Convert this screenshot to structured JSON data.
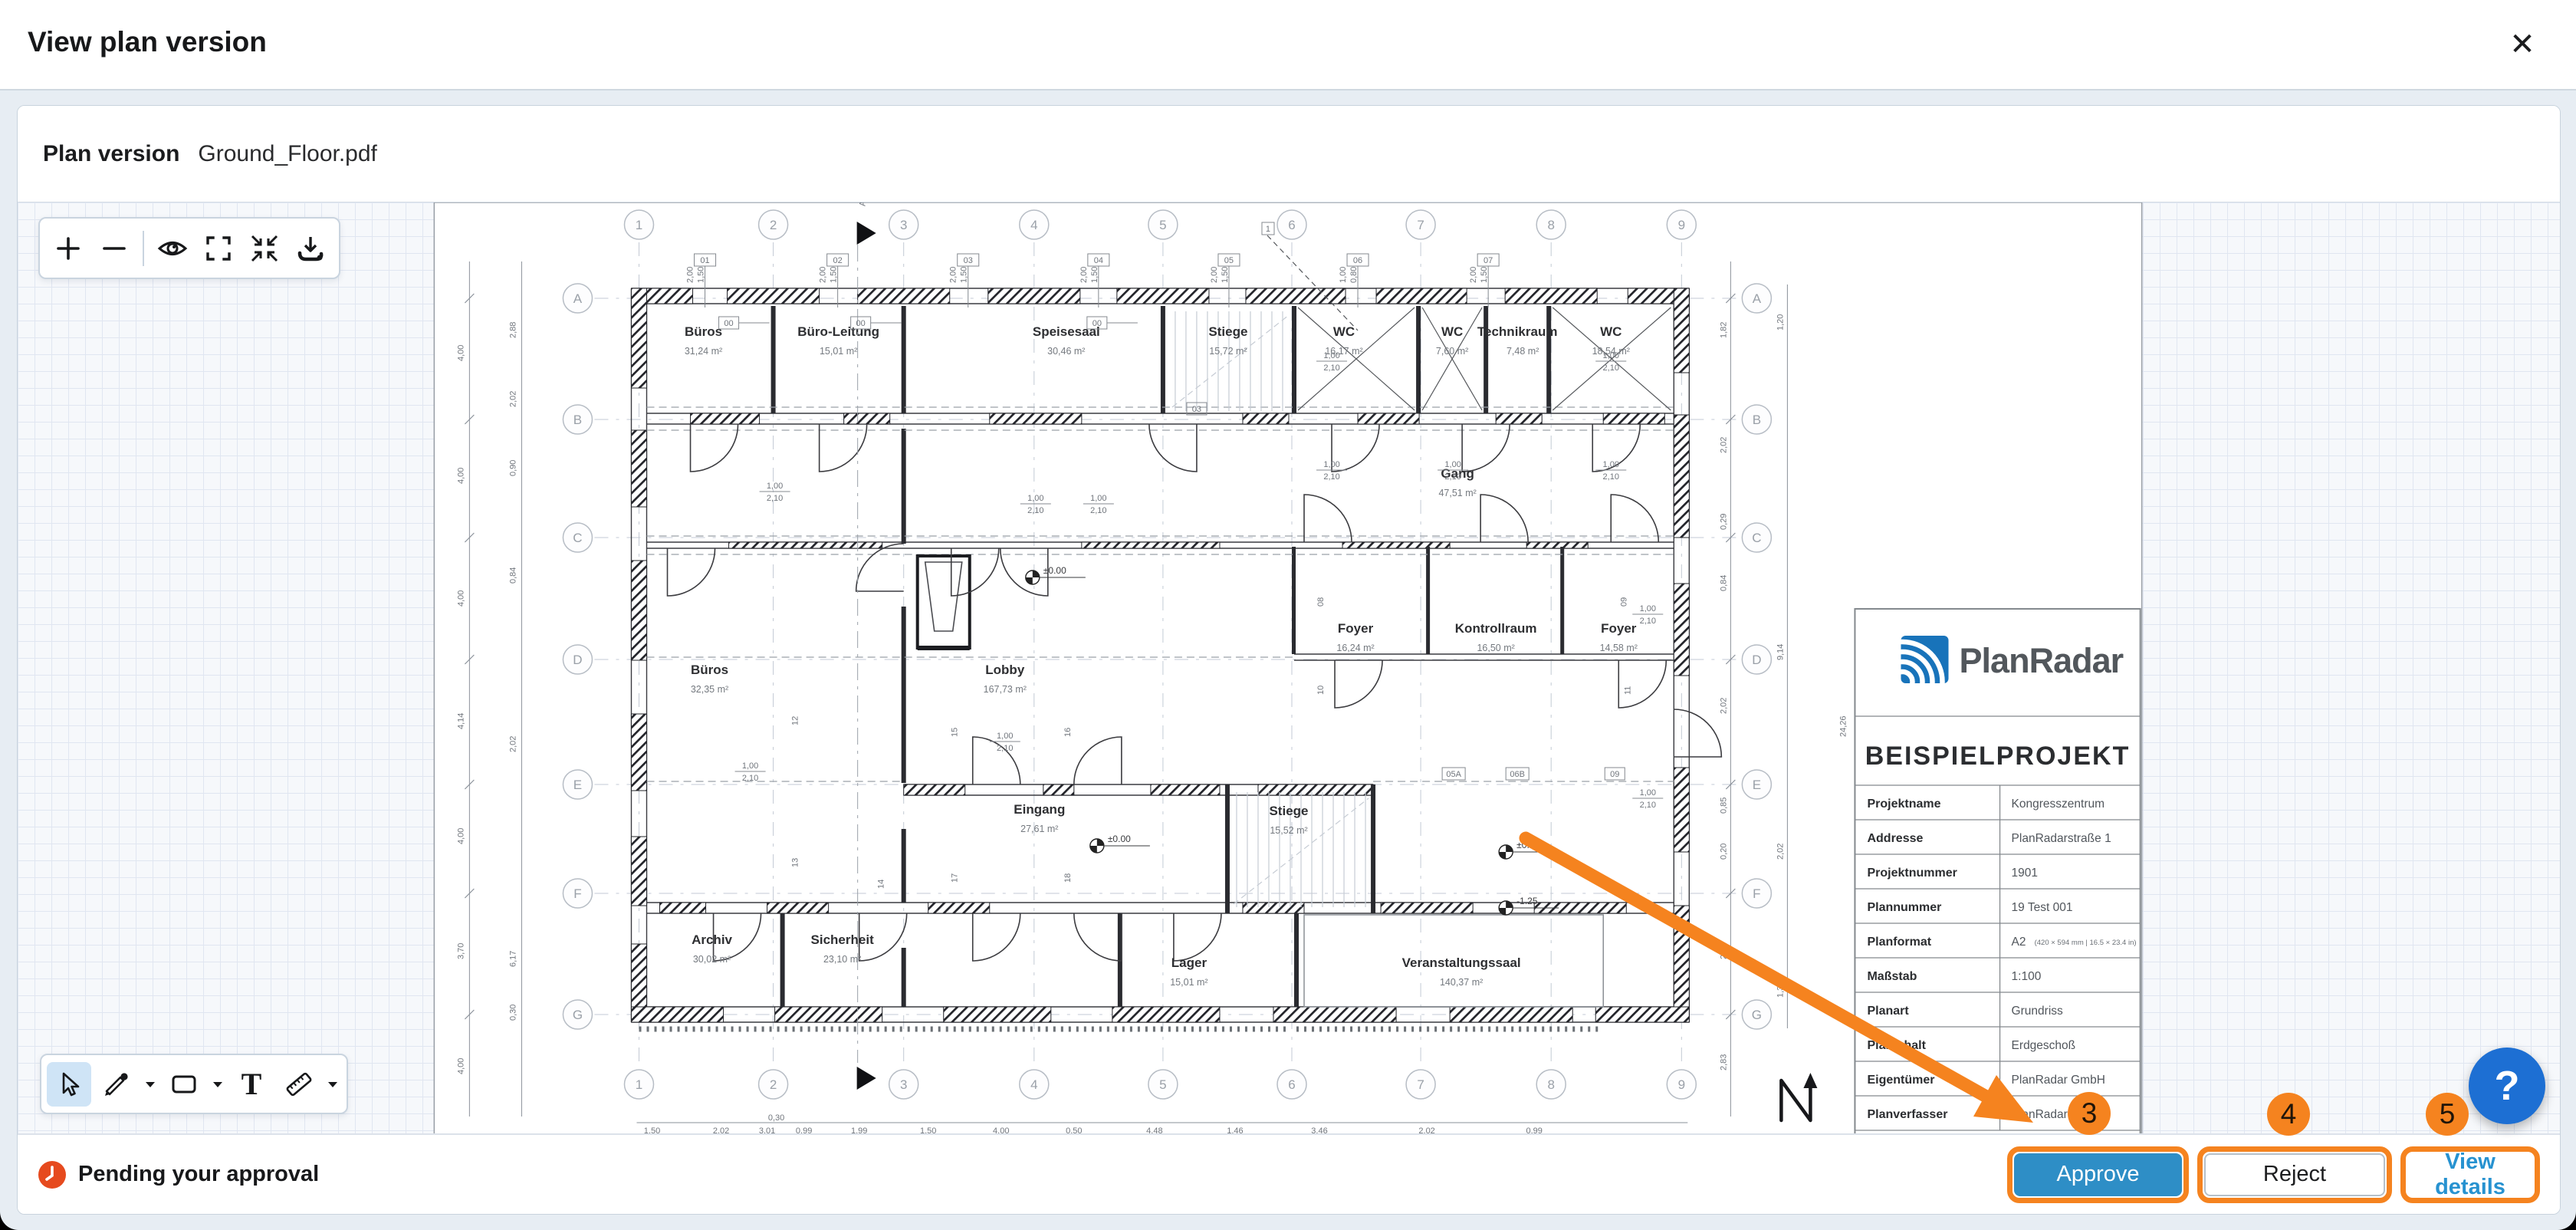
{
  "header": {
    "title": "View plan version",
    "close_icon": "✕"
  },
  "plan_version": {
    "label": "Plan version",
    "filename": "Ground_Floor.pdf"
  },
  "viewer": {
    "toolbar_top": {
      "zoom_in": "+",
      "zoom_out": "−"
    },
    "toolbar_bottom": {
      "text_tool_glyph": "T"
    }
  },
  "status": {
    "label": "Pending your approval"
  },
  "actions": {
    "approve": "Approve",
    "reject": "Reject",
    "view_details": "View details"
  },
  "annotations": {
    "badges": [
      "3",
      "4",
      "5"
    ],
    "help_glyph": "?"
  },
  "plan": {
    "grid_cols": [
      "1",
      "2",
      "3",
      "4",
      "5",
      "6",
      "7",
      "8",
      "9"
    ],
    "grid_rows": [
      "A",
      "B",
      "C",
      "D",
      "E",
      "F",
      "G"
    ],
    "rooms": [
      {
        "name": "Büros",
        "area": "31,24 m²"
      },
      {
        "name": "Büro-Leitung",
        "area": "15,01 m²"
      },
      {
        "name": "Speisesaal",
        "area": "30,46 m²"
      },
      {
        "name": "Stiege",
        "area": "15,72 m²"
      },
      {
        "name": "WC",
        "area": "16,17 m²"
      },
      {
        "name": "WC",
        "area": "7,60 m²"
      },
      {
        "name": "Technikraum",
        "area": "7,48 m²"
      },
      {
        "name": "WC",
        "area": "18,54 m²"
      },
      {
        "name": "Gang",
        "area": "47,51 m²"
      },
      {
        "name": "Büros",
        "area": "32,35 m²"
      },
      {
        "name": "Lobby",
        "area": "167,73 m²"
      },
      {
        "name": "Foyer",
        "area": "16,24 m²"
      },
      {
        "name": "Kontrollraum",
        "area": "16,50 m²"
      },
      {
        "name": "Foyer",
        "area": "14,58 m²"
      },
      {
        "name": "Eingang",
        "area": "27,61 m²"
      },
      {
        "name": "Stiege",
        "area": "15,52 m²"
      },
      {
        "name": "Archiv",
        "area": "30,02 m²"
      },
      {
        "name": "Sicherheit",
        "area": "23,10 m²"
      },
      {
        "name": "Lager",
        "area": "15,01 m²"
      },
      {
        "name": "Veranstaltungssaal",
        "area": "140,37 m²"
      }
    ],
    "title_block": {
      "brand": "PlanRadar",
      "project_title": "BEISPIELPROJEKT",
      "rows": [
        {
          "label": "Projektname",
          "value": "Kongresszentrum"
        },
        {
          "label": "Addresse",
          "value": "PlanRadarstraße 1"
        },
        {
          "label": "Projektnummer",
          "value": "1901"
        },
        {
          "label": "Plannummer",
          "value": "19 Test 001"
        },
        {
          "label": "Planformat",
          "value": "A2",
          "note": "(420 × 594 mm | 16.5 × 23.4 in)"
        },
        {
          "label": "Maßstab",
          "value": "1:100"
        },
        {
          "label": "Planart",
          "value": "Grundriss"
        },
        {
          "label": "Planinhalt",
          "value": "Erdgeschoß"
        },
        {
          "label": "Eigentümer",
          "value": "PlanRadar GmbH"
        },
        {
          "label": "Planverfasser",
          "value": "PlanRadar GmbH"
        }
      ]
    },
    "markers": {
      "level_zero": "±0.00",
      "level_minus": "-1.25",
      "section_label": "A-"
    },
    "dims": {
      "win_w": "2,00",
      "win_h": "1,50",
      "win_w2": "1,00",
      "win_h2": "0,80",
      "door_w": "1,00",
      "door_h": "2,10",
      "top_tags": [
        "01",
        "02",
        "03",
        "04",
        "05",
        "06",
        "07"
      ],
      "detail_tag": "1",
      "door_tags": [
        "00",
        "00",
        "00",
        "03",
        "05A",
        "06B",
        "09"
      ],
      "side_tags": [
        "08",
        "09",
        "10",
        "11",
        "12",
        "13",
        "14",
        "15",
        "16",
        "17",
        "18"
      ],
      "left": [
        "4,00",
        "4,00",
        "4,00",
        "4,14",
        "4,00",
        "3,70",
        "4,00"
      ],
      "left2": [
        "2,88",
        "2,02",
        "0,90",
        "0,84",
        "2,02",
        "6,17",
        "0,30"
      ],
      "right": [
        "1,82",
        "2,02",
        "0,29",
        "0,84",
        "2,02",
        "0,85",
        "0,20",
        "2,02",
        "2,83"
      ],
      "right2": [
        "1,20",
        "9,14",
        "2,02",
        "1,34"
      ],
      "block_height": "24,26",
      "bottom": [
        "1,50",
        "2,02",
        "3,01",
        "0,30",
        "0,99",
        "1,99",
        "1,50",
        "4,00",
        "0,50",
        "4,48",
        "1,46",
        "3,46",
        "2,02",
        "0,99"
      ]
    }
  }
}
